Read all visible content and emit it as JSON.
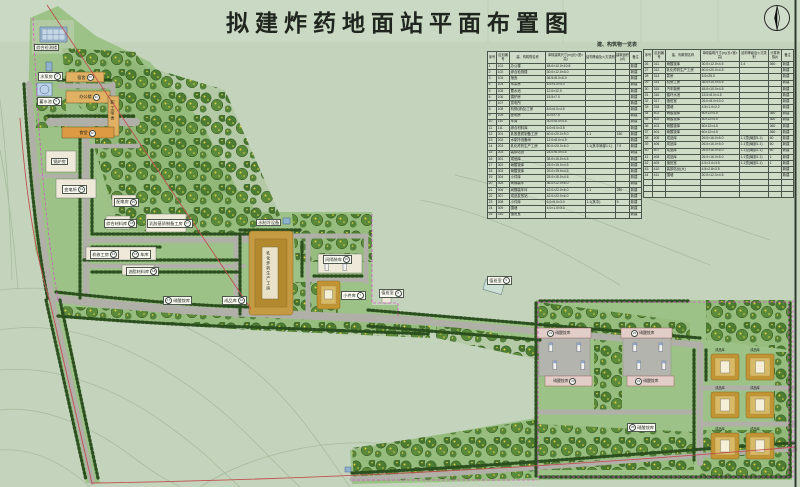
{
  "title": "拟建炸药地面站平面布置图",
  "table": {
    "caption": "建、构筑物一览表",
    "headers": [
      "序号",
      "区划编号",
      "建、构筑物名称",
      "单幢建筑尺寸(m)(长×宽×高)",
      "结构等级及火灾类别",
      "建筑面积(㎡)",
      "备注"
    ],
    "headers_right": [
      "序号",
      "区划编号",
      "建、构筑物名称",
      "单幢建筑尺寸(m)(长×宽×高)",
      "结构等级及火灾类别",
      "计算荷载(t)",
      "备注"
    ],
    "left_rows": [
      [
        "1",
        "101",
        "办公楼",
        "48.0×12.0×10.8",
        "",
        "",
        "新建"
      ],
      [
        "2",
        "102",
        "综合检测楼",
        "30.0×12.0×6.0",
        "",
        "",
        "新建"
      ],
      [
        "3",
        "103",
        "宿舍",
        "36.5×8.0×6.0",
        "",
        "",
        "新建"
      ],
      [
        "4",
        "104",
        "水泵房",
        "6.0×4.0×4.0",
        "",
        "",
        "新建"
      ],
      [
        "5",
        "105",
        "蓄水池",
        "12.0×12.0",
        "",
        "",
        "新建"
      ],
      [
        "6",
        "106",
        "锅炉房",
        "15.5×7.0",
        "",
        "",
        "新建"
      ],
      [
        "7",
        "107",
        "变电所",
        "",
        "",
        "",
        "新建"
      ],
      [
        "8",
        "108",
        "机修(综合)工房",
        "8.0×6.0×4.5",
        "",
        "",
        "新建"
      ],
      [
        "9",
        "109",
        "配电房",
        "10.0×7.0",
        "",
        "",
        "新建"
      ],
      [
        "10",
        "110",
        "车库",
        "30.0×8.0×4.5",
        "",
        "",
        "新建"
      ],
      [
        "11",
        "111",
        "综合材料库",
        "6.0×5.0×3.5",
        "",
        "",
        "新建"
      ],
      [
        "12",
        "201",
        "乳胶基质制备工房",
        "60.0×20.0×9.0",
        "1.1",
        "180",
        "新建"
      ],
      [
        "13",
        "202",
        "水制冷设备间",
        "12.0×8.0×4.5",
        "",
        "",
        "新建"
      ],
      [
        "14",
        "203",
        "乳化炸药生产工房",
        "80.0×20.0×6.0",
        "1.1(其中局部1.1)",
        "7.5",
        "新建"
      ],
      [
        "15",
        "204",
        "装卸站台",
        "25.0×6.0×4.5",
        "",
        "",
        "新建"
      ],
      [
        "16",
        "301",
        "成品库",
        "35.0×15.0×4.5",
        "",
        "",
        "新建"
      ],
      [
        "17",
        "302",
        "硝酸铵库",
        "25.0×15.0×4.5",
        "",
        "",
        "新建"
      ],
      [
        "18",
        "303",
        "硝酸铵库",
        "25.0×15.0×4.5",
        "",
        "",
        "新建"
      ],
      [
        "19",
        "304",
        "小件库",
        "25.0×15.0×4.5",
        "",
        "",
        "新建"
      ],
      [
        "20",
        "305",
        "间隔装车",
        "36.0×12.0×6.0",
        "",
        "",
        "新建"
      ],
      [
        "21",
        "306",
        "间隔装车坪",
        "42.0×22.0×6.0",
        "1.1",
        "280",
        "新建"
      ],
      [
        "22",
        "307",
        "成品发放站",
        "42.0×22.0×6.0",
        "",
        "",
        "新建"
      ],
      [
        "23",
        "308",
        "小件库",
        "6.0×5.0×3.0",
        "1.1(其中)",
        "5",
        "新建"
      ],
      [
        "24",
        "309",
        "围墙",
        "4.0×1.0×3.0",
        "",
        "",
        "新建"
      ],
      [
        "25",
        "310",
        "值班室",
        "",
        "",
        "",
        "新建"
      ]
    ],
    "right_rows": [
      [
        "26",
        "311",
        "硝酸铵库",
        "30.0×12.0×4.5",
        "1.4",
        "360",
        "新建"
      ],
      [
        "27",
        "312",
        "乳化炸药生产工房",
        "60.0×20.0×4.5",
        "",
        "",
        "新建"
      ],
      [
        "28",
        "313",
        "泵房",
        "5.0×25.0",
        "",
        "",
        "新建"
      ],
      [
        "29",
        "314",
        "机修工房",
        "36.0×10.0×4.5",
        "",
        "",
        "新建"
      ],
      [
        "30",
        "315",
        "汽车衡房",
        "45.0×10.0×4.5",
        "",
        "",
        "新建"
      ],
      [
        "31",
        "316",
        "循环水池",
        "15.0×8.0×4.5",
        "",
        "",
        "新建"
      ],
      [
        "32",
        "317",
        "值班室",
        "26.0×8.0×10.0",
        "",
        "",
        "新建"
      ],
      [
        "33",
        "318",
        "围墙",
        "4.5×1.0×2.2",
        "",
        "",
        "新建"
      ],
      [
        "34",
        "401",
        "硝酸铵库",
        "60×12×4.5",
        "",
        "360",
        "新建"
      ],
      [
        "35",
        "402",
        "硝酸铵库",
        "60×12×4.5",
        "",
        "360",
        "新建"
      ],
      [
        "36",
        "403",
        "硝酸铵库",
        "60×12×4.5",
        "",
        "360",
        "新建"
      ],
      [
        "37",
        "404",
        "硝酸铵库",
        "60×12×4.5",
        "",
        "360",
        "新建"
      ],
      [
        "38",
        "405",
        "成品库",
        "26.0×16.0×5.0",
        "1.1顶(局部1.1)",
        "60",
        "新建"
      ],
      [
        "39",
        "406",
        "成品库",
        "26.0×16.0×5.0",
        "1.1顶(局部1.1)",
        "60",
        "新建"
      ],
      [
        "40",
        "407",
        "成品库",
        "26.0×16.0×5.0",
        "1.1顶(局部1.1)",
        "60",
        "新建"
      ],
      [
        "41",
        "408",
        "成品库",
        "26.0×16.0×5.0",
        "1.1顶(局部1.1)",
        "1",
        "新建"
      ],
      [
        "42",
        "409",
        "值班室",
        "4.5×3.0×3.5",
        "1.1顶(局部1.1)",
        "1",
        "新建"
      ],
      [
        "43",
        "410",
        "装卸站台(大)",
        "4.5×2.8×3.5",
        "",
        "",
        "新建"
      ],
      [
        "44",
        "411",
        "围墙",
        "20.0×12.0×4.5",
        "",
        "",
        "新建"
      ],
      [
        "",
        "",
        "",
        "",
        "",
        "",
        ""
      ],
      [
        "",
        "",
        "",
        "",
        "",
        "",
        ""
      ],
      [
        "",
        "",
        "",
        "",
        "",
        "",
        ""
      ]
    ]
  },
  "labels": {
    "lab_building": {
      "text": "综合检测楼"
    },
    "pump": {
      "text": "水泵房",
      "num": "4"
    },
    "reservoir": {
      "text": "蓄水池",
      "num": "5"
    },
    "dorm": {
      "text": "宿舍",
      "num": "10"
    },
    "office": {
      "text": "办公楼",
      "num": "11"
    },
    "staff_dorm": {
      "text": "职工宿舍"
    },
    "canteen": {
      "text": "食堂",
      "num": "12"
    },
    "boiler": {
      "text": "锅炉房"
    },
    "substation": {
      "text": "变电所",
      "num": "14"
    },
    "power_room": {
      "text": "配电房",
      "num": "15"
    },
    "material_store": {
      "text": "综合材料库",
      "num": "16"
    },
    "latex_plant": {
      "text": "乳胶基质制备工房",
      "num": "17"
    },
    "mech_shop": {
      "text": "机修工房",
      "num": "13"
    },
    "garage": {
      "text": "车库",
      "num": "16"
    },
    "oil_store": {
      "text": "油脂材料库",
      "num": "18"
    },
    "production": {
      "text": "乳化炸药生产工房"
    },
    "chiller": {
      "text": "水制冷设备"
    },
    "interval_loading": {
      "text": "间隔装车",
      "num": "20"
    },
    "small_store": {
      "text": "小件库",
      "num": "7"
    },
    "duty1": {
      "text": "值班室",
      "num": "8"
    },
    "duty2": {
      "text": "值班室",
      "num": "9"
    },
    "an_road": {
      "text": "硝酸铵库",
      "num": "17"
    },
    "cp_road": {
      "text": "成品库",
      "num": "19"
    },
    "an1": {
      "text": "硝酸铵库",
      "num": "21"
    },
    "an2": {
      "text": "硝酸铵库",
      "num": "22"
    },
    "an3": {
      "text": "硝酸铵库",
      "num": "23"
    },
    "an4": {
      "text": "硝酸铵库",
      "num": "24"
    },
    "an5": {
      "text": "硝酸铵库",
      "num": "25"
    },
    "chengpinku": {
      "text": "成品库"
    }
  },
  "colors": {
    "paper": "#c4d4bc",
    "site_green": "#9cc287",
    "road": "#b0b0a8",
    "tree_dark": "#2b4f1f",
    "building_tan": "#e0b063",
    "building_orange": "#dd9a42",
    "building_white": "#eee9d8",
    "building_blue": "#9db8cf",
    "warehouse_pink": "#e3cdc9",
    "mound_tan": "#c19434",
    "boundary_red": "#c05050",
    "fence_magenta": "#d557c8"
  }
}
